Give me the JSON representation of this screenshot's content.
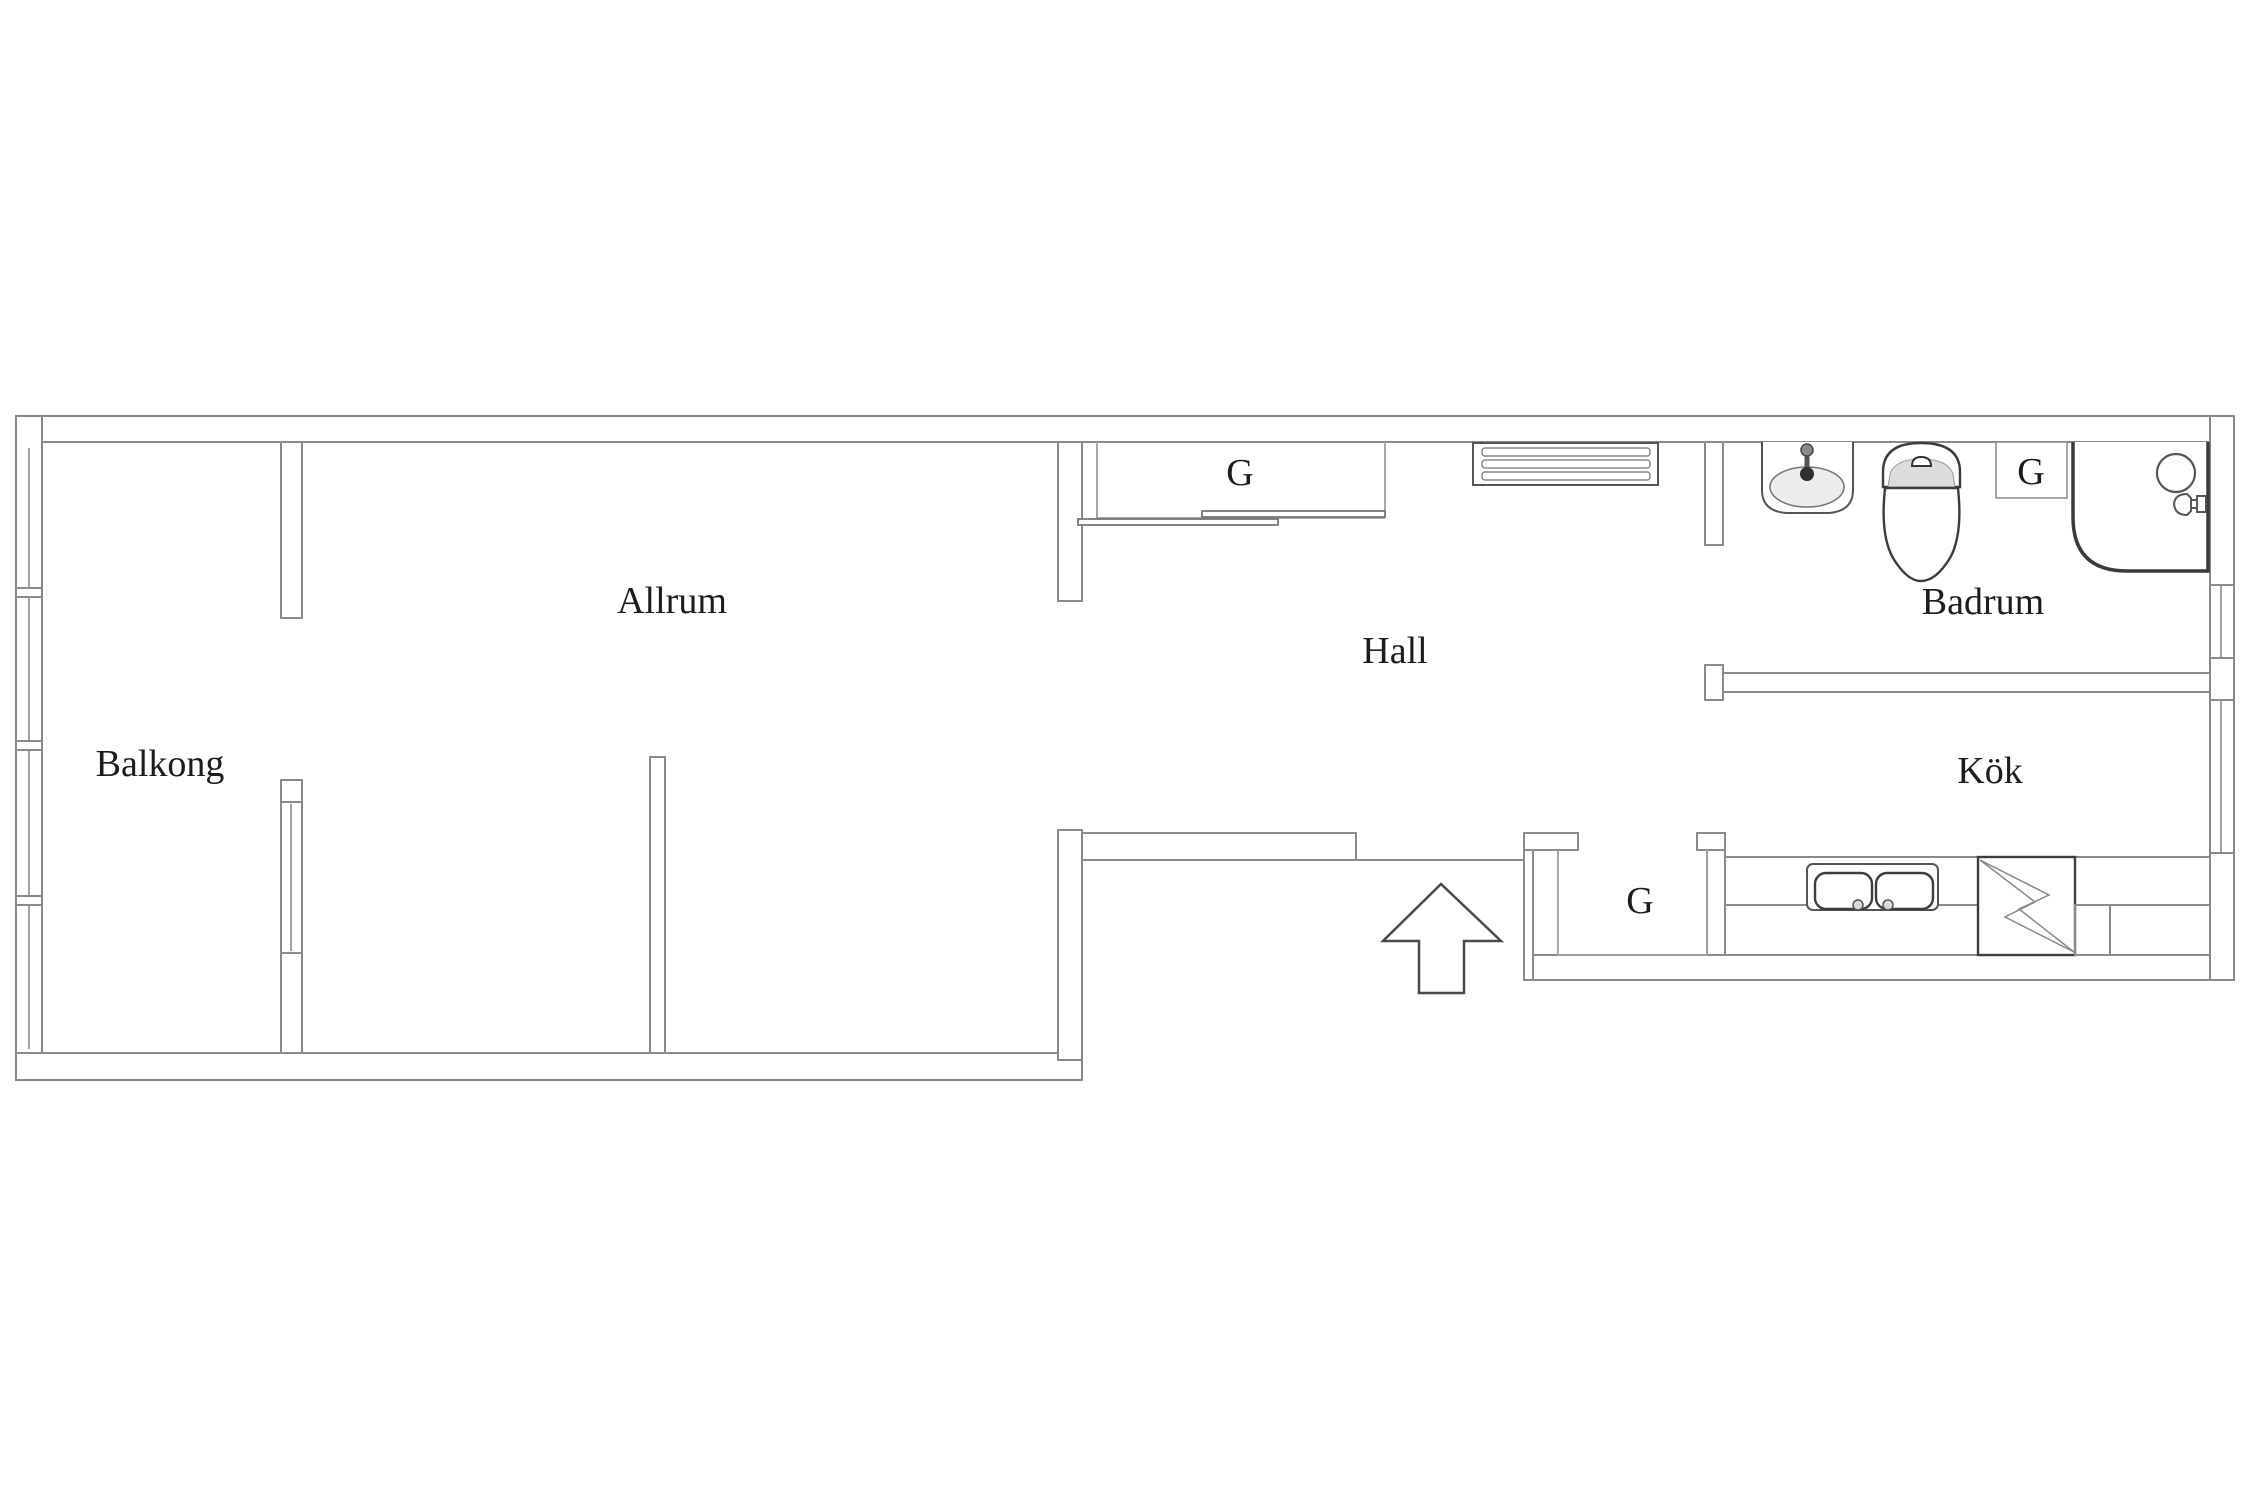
{
  "floorplan": {
    "title": "Apartment floor plan",
    "rooms": {
      "balkong": {
        "label": "Balkong"
      },
      "allrum": {
        "label": "Allrum"
      },
      "hall": {
        "label": "Hall"
      },
      "badrum": {
        "label": "Badrum"
      },
      "kok": {
        "label": "Kök"
      }
    },
    "closet_label": "G",
    "icons": {
      "entrance_arrow": "entrance-direction-arrow",
      "radiator": "radiator-grille",
      "bath_sink": "washbasin-with-faucet",
      "toilet": "toilet",
      "shower": "shower-corner-with-head-and-sprayer",
      "kitchen_sink": "double-bowl-kitchen-sink",
      "stove": "electric-stove-lightning-bolt",
      "wardrobe_doors": "sliding-wardrobe-doors",
      "windows": "window-glazing-lines"
    },
    "colors": {
      "background": "#ffffff",
      "wall_line": "#8a8a8a",
      "fixture_line": "#555555",
      "dark_line": "#3c3c3c",
      "text": "#1c1c1c",
      "shading": "#dcdcdc"
    }
  }
}
